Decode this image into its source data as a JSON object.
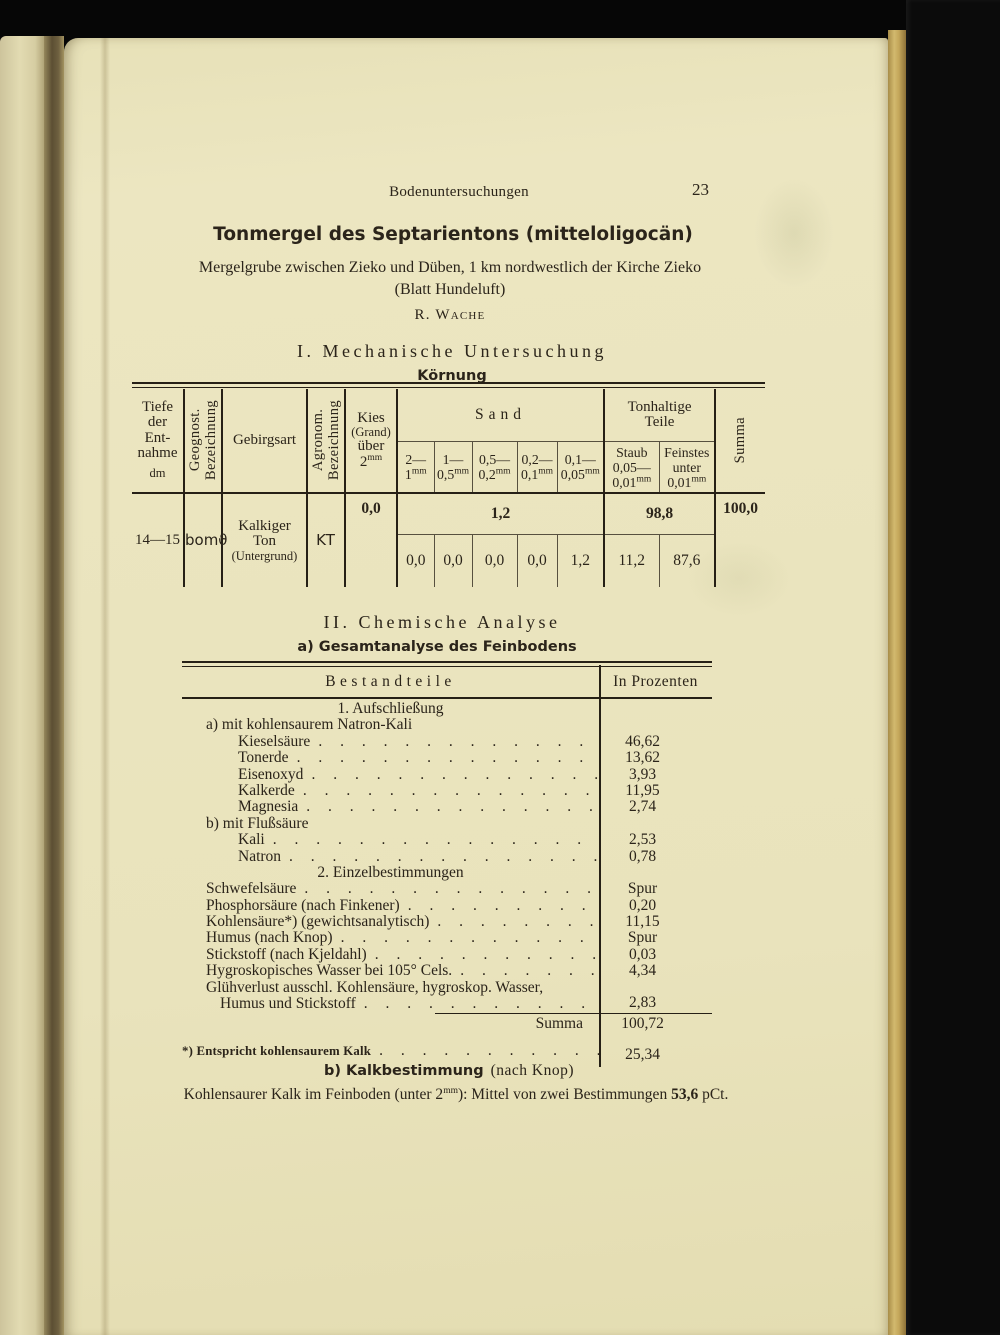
{
  "page_header": {
    "running_head": "Bodenuntersuchungen",
    "page_number": "23"
  },
  "heading": {
    "title": "Tonmergel des Septarientons (mitteloligocän)",
    "subtitle": "Mergelgrube zwischen Zieko und Düben, 1 km nordwestlich der Kirche Zieko",
    "subtitle2": "(Blatt Hundeluft)",
    "author": "R. Wache"
  },
  "section1": {
    "heading": "I. Mechanische Untersuchung",
    "subheading": "Körnung",
    "table": {
      "col_tiefe": {
        "lines": [
          "Tiefe",
          "der",
          "Ent-",
          "nahme"
        ],
        "unit": "dm"
      },
      "col_geognost": [
        "Geognost.",
        "Bezeichnung"
      ],
      "col_gebirgsart": "Gebirgsart",
      "col_agronom": [
        "Agronom.",
        "Bezeichnung"
      ],
      "col_kies": {
        "lines": [
          "Kies",
          "(Grand)",
          "über"
        ],
        "limit": "2",
        "unit": "mm"
      },
      "group_sand": "Sand",
      "sand_cols": [
        {
          "hi": "2—",
          "lo": "1",
          "unit": "mm"
        },
        {
          "hi": "1—",
          "lo": "0,5",
          "unit": "mm"
        },
        {
          "hi": "0,5—",
          "lo": "0,2",
          "unit": "mm"
        },
        {
          "hi": "0,2—",
          "lo": "0,1",
          "unit": "mm"
        },
        {
          "hi": "0,1—",
          "lo": "0,05",
          "unit": "mm"
        }
      ],
      "group_ton": [
        "Tonhaltige",
        "Teile"
      ],
      "ton_cols": [
        {
          "name": "Staub",
          "hi": "0,05—",
          "lo": "0,01",
          "unit": "mm"
        },
        {
          "name": "Feinstes",
          "hi": "unter",
          "lo": "0,01",
          "unit": "mm"
        }
      ],
      "col_summa": "Summa",
      "row": {
        "tiefe": "14—15",
        "geognost": "bomϑ",
        "gebirgsart1": "Kalkiger",
        "gebirgsart2": "Ton",
        "gebirgsart3": "(Untergrund)",
        "agronom": "KT",
        "kies": "0,0",
        "sand_total": "1,2",
        "sand_values": [
          "0,0",
          "0,0",
          "0,0",
          "0,0",
          "1,2"
        ],
        "ton_total": "98,8",
        "ton_values": [
          "11,2",
          "87,6"
        ],
        "summa": "100,0"
      }
    }
  },
  "section2": {
    "heading": "II. Chemische Analyse",
    "subheading": "a) Gesamtanalyse des Feinbodens",
    "table": {
      "col1": "Bestandteile",
      "col2": "In Prozenten",
      "rows": [
        {
          "style": "center",
          "text": "1. Aufschließung"
        },
        {
          "style": "plain",
          "text": "a) mit kohlensaurem Natron-Kali",
          "indent": 1
        },
        {
          "style": "leader",
          "label": "Kieselsäure",
          "value": "46,62",
          "indent": 2
        },
        {
          "style": "leader",
          "label": "Tonerde",
          "value": "13,62",
          "indent": 2
        },
        {
          "style": "leader",
          "label": "Eisenoxyd",
          "value": "3,93",
          "indent": 2
        },
        {
          "style": "leader",
          "label": "Kalkerde",
          "value": "11,95",
          "indent": 2
        },
        {
          "style": "leader",
          "label": "Magnesia",
          "value": "2,74",
          "indent": 2
        },
        {
          "style": "plain",
          "text": "b) mit Flußsäure",
          "indent": 1
        },
        {
          "style": "leader",
          "label": "Kali",
          "value": "2,53",
          "indent": 2
        },
        {
          "style": "leader",
          "label": "Natron",
          "value": "0,78",
          "indent": 2
        },
        {
          "style": "center",
          "text": "2. Einzelbestimmungen"
        },
        {
          "style": "leader",
          "label": "Schwefelsäure",
          "value": "Spur",
          "indent": 1
        },
        {
          "style": "leader",
          "label": "Phosphorsäure (nach Finkener)",
          "value": "0,20",
          "indent": 1
        },
        {
          "style": "leader",
          "label": "Kohlensäure*) (gewichtsanalytisch)",
          "value": "11,15",
          "indent": 1
        },
        {
          "style": "leader",
          "label": "Humus (nach Knop)",
          "value": "Spur",
          "indent": 1
        },
        {
          "style": "leader",
          "label": "Stickstoff (nach Kjeldahl)",
          "value": "0,03",
          "indent": 1
        },
        {
          "style": "leader",
          "label": "Hygroskopisches Wasser bei 105° Cels.",
          "value": "4,34",
          "indent": 1
        },
        {
          "style": "wrap2",
          "line1": "Glühverlust ausschl. Kohlensäure, hygroskop. Wasser,",
          "line2": "Humus und Stickstoff",
          "value": "2,83",
          "indent": 1
        },
        {
          "style": "summa",
          "label": "Summa",
          "value": "100,72",
          "rule_before": true
        },
        {
          "style": "footnote",
          "label": "*) Entspricht kohlensaurem Kalk",
          "value": "25,34"
        }
      ]
    }
  },
  "section3": {
    "heading_bold": "b) Kalkbestimmung",
    "heading_rest": "(nach Knop)",
    "line_pre": "Kohlensaurer Kalk im Feinboden (unter 2",
    "line_sup": "mm",
    "line_mid": "): Mittel von zwei Bestimmungen ",
    "line_bold": "53,6",
    "line_post": " pCt."
  }
}
